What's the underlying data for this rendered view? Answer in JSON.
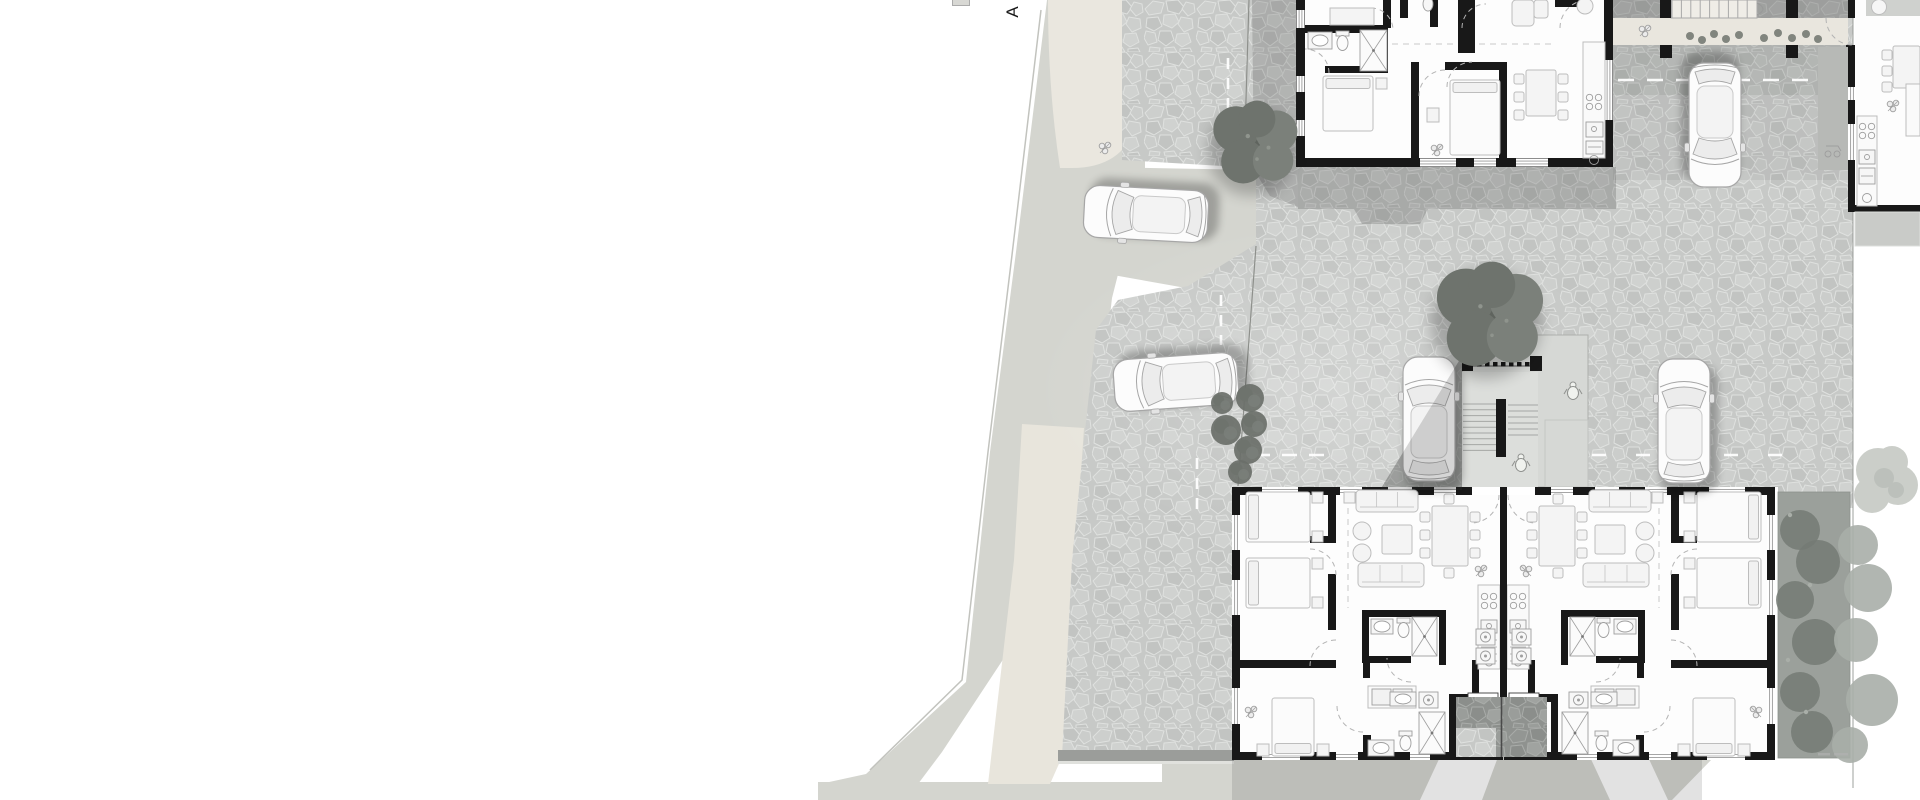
{
  "section_marker": {
    "label": "A"
  },
  "colors": {
    "background": "#ffffff",
    "road": "#d4d5cf",
    "road_edge": "#c2c3be",
    "sidewalk": "#e8e5dc",
    "driveway": "#eae7df",
    "walkway": "#e9e6de",
    "paving_base": "#c7c9c7",
    "paving_joint": "#dfe1df",
    "paving_cells": [
      "#cdcfcd",
      "#c2c4c2",
      "#cbcdcb",
      "#d0d2d0"
    ],
    "paving_dark_base": "#8f928f",
    "paving_dark_joint": "#a9aca9",
    "paving_dark_cells": [
      "#939693",
      "#8b8e8b",
      "#9a9d9a",
      "#a0a3a0"
    ],
    "curb": "#9b9d9a",
    "curb_light": "#e0e1dd",
    "wall": "#181818",
    "interior": "#fdfdfd",
    "furniture_fill": "#f4f4f4",
    "furniture_stroke": "#bdbdbd",
    "fixture_stroke": "#9e9e9e",
    "door_arc": "#b3b3b3",
    "hall_dash": "#c9c9c9",
    "window_line": "#9a9a9a",
    "dash_line": "#ffffff",
    "boundary": "#8e908c",
    "platform": "#d6d8d5",
    "platform_light": "#dcdedb",
    "tread": "#a5a7a4",
    "shadow": "#3a3d3a",
    "tree_deep": "#5f645e",
    "tree_mid": "#6e736d",
    "tree_soft": "#7b807a",
    "tree_speckle": "#8f948d",
    "shrub": "#6a6f69",
    "garden_base": "#9ba09b",
    "garden_blob": "#747a74",
    "garden_spill": "#a9aea8",
    "tree_light_fill": "#cbcec9",
    "tree_light_inner": "#bcc0bb",
    "car_body": "#fcfcfc",
    "car_outline": "#a6a6a6",
    "car_glass": "#ececec",
    "car_roof": "#f3f3f3",
    "terrace": "#c9cbc8",
    "porch": "#b7b9b6",
    "patio": "#cfd1ce",
    "stair_fill": "#efede7",
    "stair_stringer": "#a9a9a9",
    "person_stroke": "#8f918e",
    "vestibule_divider": "#4a4a4a",
    "threshold_stroke": "#3c3c3c",
    "scale_mark": "#b0b0b0",
    "label_color": "#1a1a1a"
  },
  "inventory": {
    "site": [
      "street",
      "driveway-entrance",
      "sidewalk",
      "stone-paved-courtyard",
      "parking-bays",
      "walkway",
      "entry-vestibule",
      "section-cut-marker"
    ],
    "buildings": [
      {
        "name": "north-building",
        "rooms": [
          "bathroom",
          "bedroom",
          "bedroom",
          "dining-area",
          "kitchen",
          "hallway",
          "wc"
        ]
      },
      {
        "name": "east-building",
        "rooms": [
          "patio",
          "dining-area",
          "kitchen",
          "terrace",
          "porch"
        ]
      },
      {
        "name": "south-building",
        "units": 2,
        "rooms_per_unit": [
          "bedroom",
          "bedroom",
          "bedroom",
          "living-room",
          "dining-area",
          "kitchen",
          "bathroom",
          "en-suite",
          "laundry",
          "entry-vestibule"
        ]
      }
    ],
    "stair_core": [
      "exterior-stair",
      "landing-platform",
      "railing-balusters",
      "person-figure",
      "person-figure"
    ],
    "cars": [
      "street-car",
      "courtyard-car",
      "parked-car-north",
      "parked-car-west",
      "parked-car-east"
    ],
    "vegetation": [
      "north-tree",
      "courtyard-tree",
      "boundary-shrubs",
      "garden-hedge",
      "walkway-planting",
      "light-tree"
    ]
  }
}
